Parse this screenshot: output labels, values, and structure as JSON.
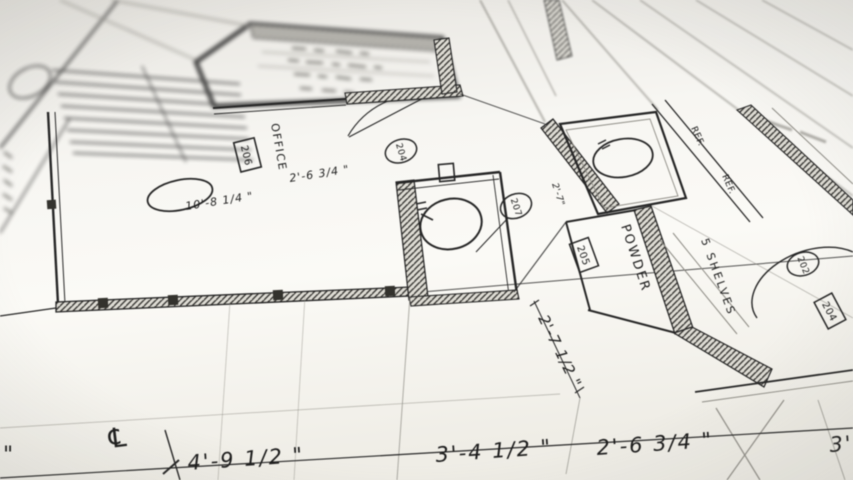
{
  "labels": {
    "office": "OFFICE",
    "office_tag": "206",
    "powder": "POWDER",
    "powder_tag": "205",
    "shelves": "5 SHELVES",
    "ref_upper": "REF.",
    "ref_lower": "REF.",
    "door_tag_office": "204",
    "door_tag_hall": "207",
    "door_tag_right": "202",
    "room_tag_right": "204"
  },
  "dimensions": {
    "office_width": "2'-6 3/4 \"",
    "office_depth": "10'-8 1/4 \"",
    "closet_width": "2'-7\"",
    "powder_depth": "2'-7 1/2 \"",
    "bottom_span_1": "4'-9 1/2 \"",
    "bottom_span_2": "3'-4 1/2 \"",
    "bottom_span_3": "2'-6 3/4 \"",
    "bottom_span_4": "3'",
    "leading_inch_mark": "\"",
    "centerline_symbol": "℄"
  }
}
